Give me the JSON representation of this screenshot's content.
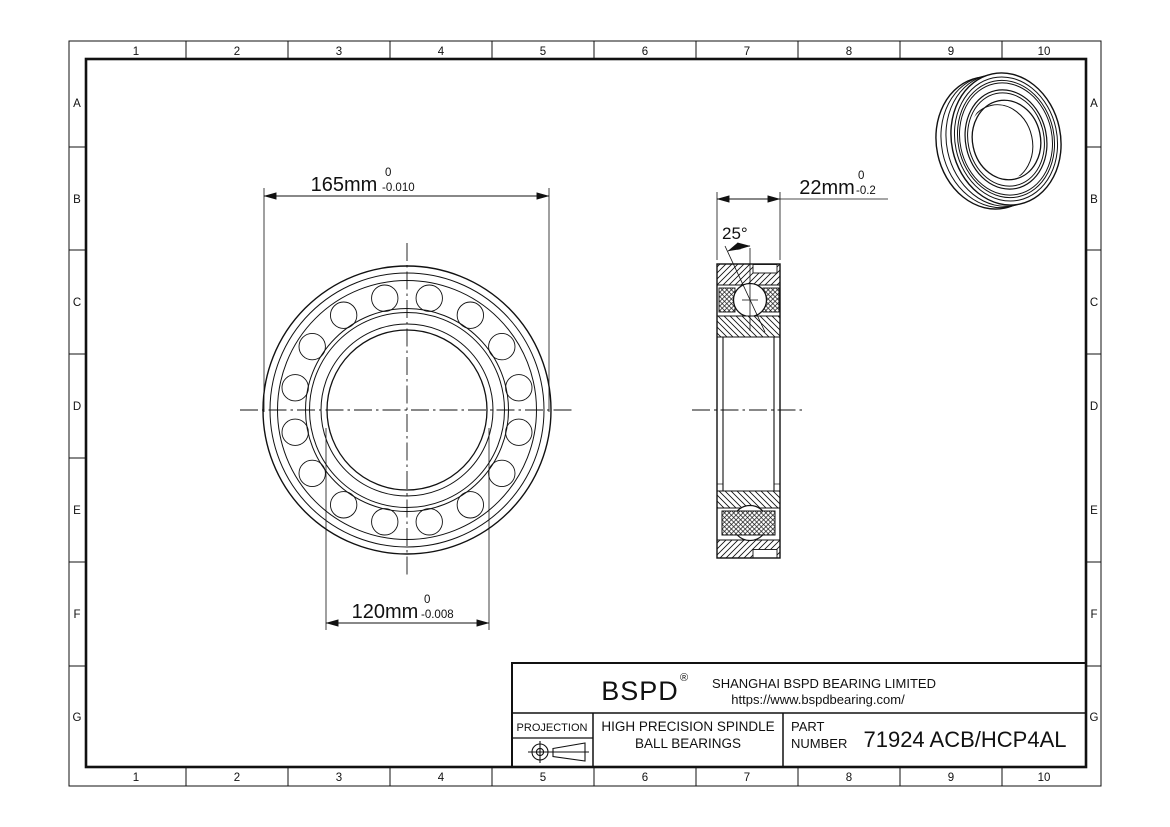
{
  "grid": {
    "columns": [
      "1",
      "2",
      "3",
      "4",
      "5",
      "6",
      "7",
      "8",
      "9",
      "10"
    ],
    "rows": [
      "A",
      "B",
      "C",
      "D",
      "E",
      "F",
      "G"
    ]
  },
  "dimensions": {
    "od": {
      "value": "165mm",
      "tol_upper": "0",
      "tol_lower": "-0.010"
    },
    "bore": {
      "value": "120mm",
      "tol_upper": "0",
      "tol_lower": "-0.008"
    },
    "width": {
      "value": "22mm",
      "tol_upper": "0",
      "tol_lower": "-0.2"
    },
    "contact_angle": {
      "value": "25°"
    }
  },
  "title_block": {
    "logo": "BSPD",
    "registered": "®",
    "company": "SHANGHAI BSPD BEARING LIMITED",
    "website": "https://www.bspdbearing.com/",
    "projection_label": "PROJECTION",
    "product_line1": "HIGH  PRECISION SPINDLE",
    "product_line2": "BALL BEARINGS",
    "part_label1": "PART",
    "part_label2": "NUMBER",
    "part_number": "71924 ACB/HCP4AL"
  },
  "line_color": "#111111"
}
